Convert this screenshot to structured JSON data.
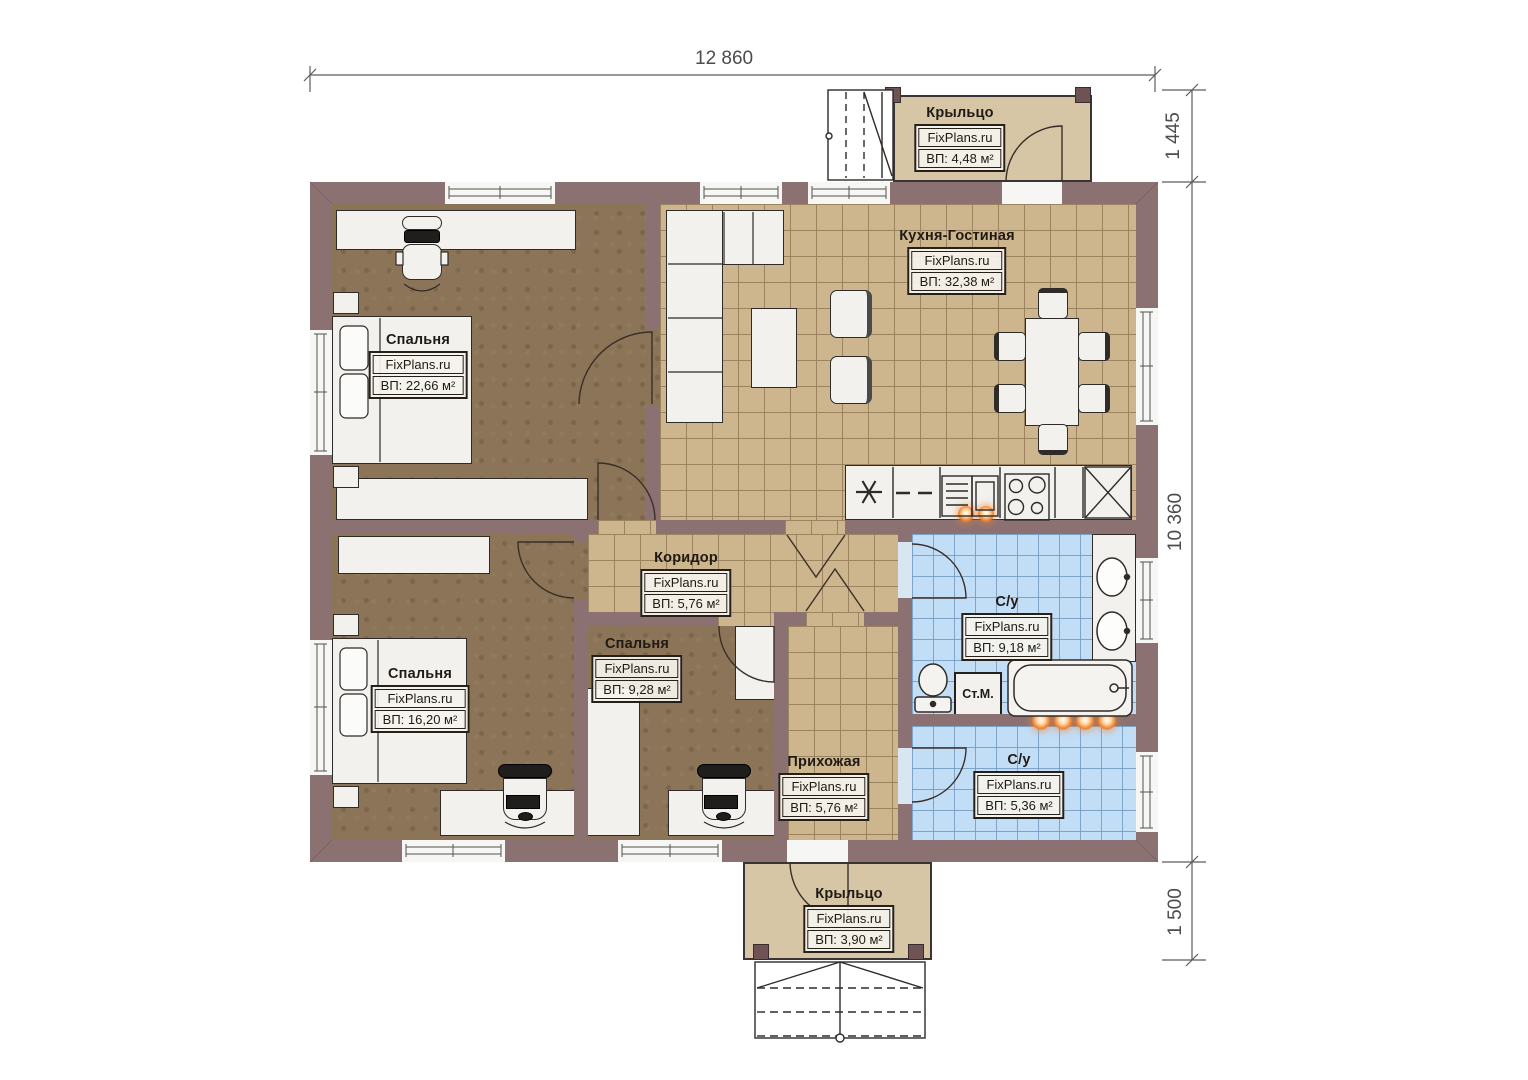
{
  "dimensions": {
    "width_top": "12 860",
    "right_top": "1 445",
    "right_main": "10 360",
    "right_bottom": "1 500"
  },
  "labels": {
    "porch_top": {
      "name": "Крыльцо",
      "brand": "FixPlans.ru",
      "area": "ВП: 4,48 м²"
    },
    "kitchen_living": {
      "name": "Кухня-Гостиная",
      "brand": "FixPlans.ru",
      "area": "ВП: 32,38 м²"
    },
    "bedroom_large": {
      "name": "Спальня",
      "brand": "FixPlans.ru",
      "area": "ВП: 22,66 м²"
    },
    "corridor": {
      "name": "Коридор",
      "brand": "FixPlans.ru",
      "area": "ВП: 5,76 м²"
    },
    "bedroom_small": {
      "name": "Спальня",
      "brand": "FixPlans.ru",
      "area": "ВП: 9,28 м²"
    },
    "bedroom_medium": {
      "name": "Спальня",
      "brand": "FixPlans.ru",
      "area": "ВП: 16,20 м²"
    },
    "bathroom_main": {
      "name": "С/у",
      "brand": "FixPlans.ru",
      "area": "ВП: 9,18 м²"
    },
    "hallway": {
      "name": "Прихожая",
      "brand": "FixPlans.ru",
      "area": "ВП: 5,76 м²"
    },
    "bathroom_second": {
      "name": "С/у",
      "brand": "FixPlans.ru",
      "area": "ВП: 5,36 м²"
    },
    "porch_bottom": {
      "name": "Крыльцо",
      "brand": "FixPlans.ru",
      "area": "ВП: 3,90 м²"
    }
  },
  "appliances": {
    "washing_machine_label": "Ст.М."
  },
  "colors": {
    "wall": "#8c7173",
    "carpet": "#8b7457",
    "tile_tan": "#cdb58e",
    "tile_blue": "#c2ddf6",
    "porch": "#d6c6a5",
    "accent_orange": "#ef8330",
    "dimension_text": "#4c4c4c"
  }
}
